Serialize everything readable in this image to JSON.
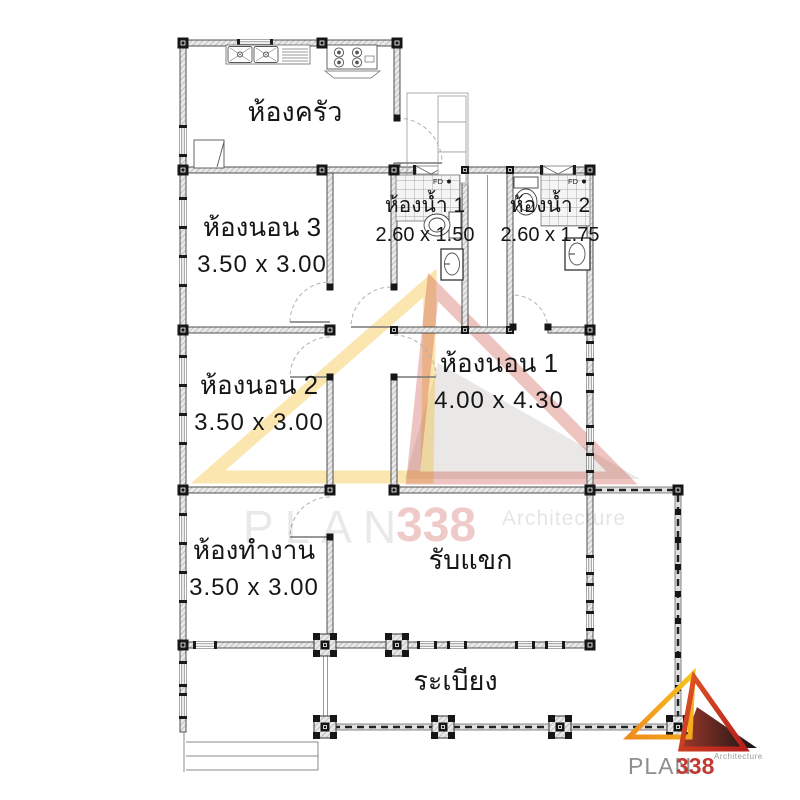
{
  "rooms": [
    {
      "id": "kitchen",
      "label": "ห้องครัว",
      "dimensions": ""
    },
    {
      "id": "bedroom-3",
      "label": "ห้องนอน 3",
      "dimensions": "3.50 x 3.00"
    },
    {
      "id": "bathroom-1",
      "label": "ห้องน้ำ 1",
      "dimensions": "2.60 x 1.50"
    },
    {
      "id": "bathroom-2",
      "label": "ห้องน้ำ 2",
      "dimensions": "2.60 x 1.75"
    },
    {
      "id": "bedroom-2",
      "label": "ห้องนอน 2",
      "dimensions": "3.50 x 3.00"
    },
    {
      "id": "bedroom-1",
      "label": "ห้องนอน 1",
      "dimensions": "4.00 x 4.30"
    },
    {
      "id": "office",
      "label": "ห้องทำงาน",
      "dimensions": "3.50 x 3.00"
    },
    {
      "id": "living",
      "label": "รับแขก",
      "dimensions": ""
    },
    {
      "id": "porch",
      "label": "ระเบียง",
      "dimensions": ""
    }
  ],
  "annotations": {
    "floor_drain": "FD"
  },
  "watermark": {
    "plan": "PLAN",
    "number": "338",
    "architecture": "Architecture"
  },
  "logo": {
    "plan": "PLAN",
    "number": "338",
    "architecture": "Architecture"
  },
  "colors": {
    "wall_line": "#3f3f3f",
    "column": "#161616",
    "logo_yellow": "#f2b617",
    "logo_orange": "#ee8c1e",
    "logo_red": "#c0281e",
    "logo_dark": "#141414",
    "logo_text_gray": "#8e8e8e",
    "logo_text_red": "#c23b33",
    "watermark_red": "#c13e38"
  }
}
